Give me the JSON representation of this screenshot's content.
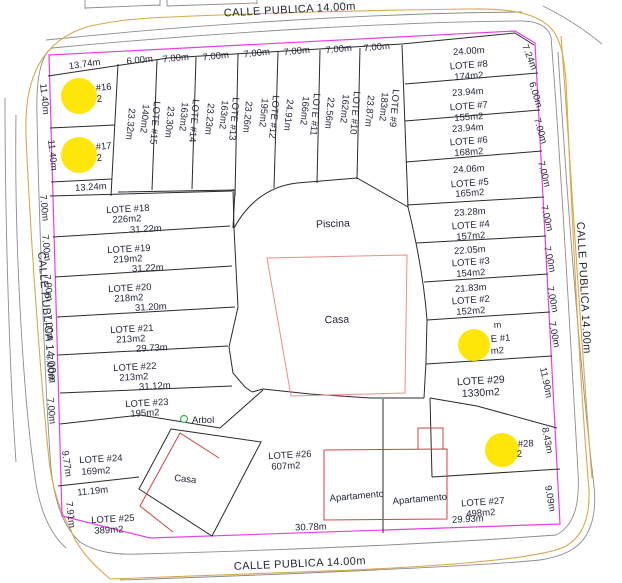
{
  "streets": {
    "top": "CALLE PUBLICA 14.00m",
    "bottom": "CALLE PUBLICA 14.00m",
    "left": "CALLE PUBLICA 14.00m",
    "right": "CALLE PUBLICA 14.00m"
  },
  "colors": {
    "boundary_magenta": "#e83ee8",
    "lot_line": "#2a2a2a",
    "building_red": "#cc4444",
    "building_light_red": "#e88e8e",
    "street_centerline": "#d7a84c",
    "street_edge": "#8c8c8c",
    "redaction_yellow": "#ffe60a",
    "tree_green": "#3db24a",
    "text": "#232838"
  },
  "top_lots": {
    "lot16": {
      "name": "#16",
      "area": "2",
      "top": "13.74m",
      "left": "11.40m"
    },
    "lot17": {
      "name": "#17",
      "area": "2",
      "left": "11.40m",
      "bottom": "13.24m"
    }
  },
  "strip_lots": [
    {
      "name": "LOTE #15",
      "area": "140m2",
      "width": "6.00m",
      "side": "23.32m"
    },
    {
      "name": "LOTE #14",
      "area": "163m2",
      "width": "7.00m",
      "side": "23.30m"
    },
    {
      "name": "LOTE #13",
      "area": "163m2",
      "width": "7.00m",
      "side": "23.23m"
    },
    {
      "name": "LOTE #12",
      "area": "195m2",
      "width": "7.00m",
      "side": "23.26m"
    },
    {
      "name": "LOTE #11",
      "area": "166m2",
      "width": "7.00m",
      "side": "24.91m"
    },
    {
      "name": "LOTE #10",
      "area": "162m2",
      "width": "7.00m",
      "side": "22.56m"
    },
    {
      "name": "LOTE #9",
      "area": "183m2",
      "width": "7.00m",
      "side": "23.87m"
    }
  ],
  "right_lots": [
    {
      "name": "LOTE #8",
      "area": "174m2",
      "front": "24.00m",
      "side": "7.24m"
    },
    {
      "name": "LOTE #7",
      "area": "155m2",
      "front": "23.94m",
      "side": "6.00m"
    },
    {
      "name": "LOTE #6",
      "area": "168m2",
      "front": "23.94m",
      "side": "7.00m"
    },
    {
      "name": "LOTE #5",
      "area": "165m2",
      "front": "24.06m",
      "side": "7.00m"
    },
    {
      "name": "LOTE #4",
      "area": "157m2",
      "front": "23.28m",
      "side": "7.00m"
    },
    {
      "name": "LOTE #3",
      "area": "154m2",
      "front": "22.05m",
      "side": "7.00m"
    },
    {
      "name": "LOTE #2",
      "area": "152m2",
      "front": "21.83m",
      "side": "7.00m"
    },
    {
      "name": "E #1",
      "area": "m2",
      "front": "m",
      "side": "7.00m"
    }
  ],
  "lower_right_lots": {
    "lot29": {
      "name": "LOTE #29",
      "area": "1330m2",
      "side": "11.90m"
    },
    "lot28": {
      "name": "#28",
      "area": "2",
      "side": "8.43m"
    },
    "lot27": {
      "name": "LOTE #27",
      "area": "498m2",
      "side": "9.09m",
      "bottom": "29.93m"
    }
  },
  "left_lots": [
    {
      "name": "LOTE #18",
      "area": "226m2",
      "bottom": "31.22m",
      "side": "7.00m"
    },
    {
      "name": "LOTE #19",
      "area": "219m2",
      "bottom": "31.22m",
      "side": "7.00m"
    },
    {
      "name": "LOTE #20",
      "area": "218m2",
      "bottom": "31.20m",
      "side": "7.00m"
    },
    {
      "name": "LOTE #21",
      "area": "213m2",
      "bottom": "29.73m",
      "side": "7.00m"
    },
    {
      "name": "LOTE #22",
      "area": "213m2",
      "bottom": "31.12m",
      "side": "7.00m"
    },
    {
      "name": "LOTE #23",
      "area": "195m2",
      "side": "7.00m"
    }
  ],
  "lower_left_lots": {
    "lot24": {
      "name": "LOTE #24",
      "area": "169m2",
      "side": "9.77m",
      "bottom": "11.19m"
    },
    "lot25": {
      "name": "LOTE #25",
      "area": "389m2",
      "side": "7.91m"
    },
    "lot26": {
      "name": "LOTE #26",
      "area": "607m2",
      "bottom": "30.78m"
    }
  },
  "features": {
    "pool": "Piscina",
    "house_center": "Casa",
    "house_lower": "Casa",
    "apartment_left": "Apartamento",
    "apartment_right": "Apartamento",
    "tree": "Arbol"
  }
}
